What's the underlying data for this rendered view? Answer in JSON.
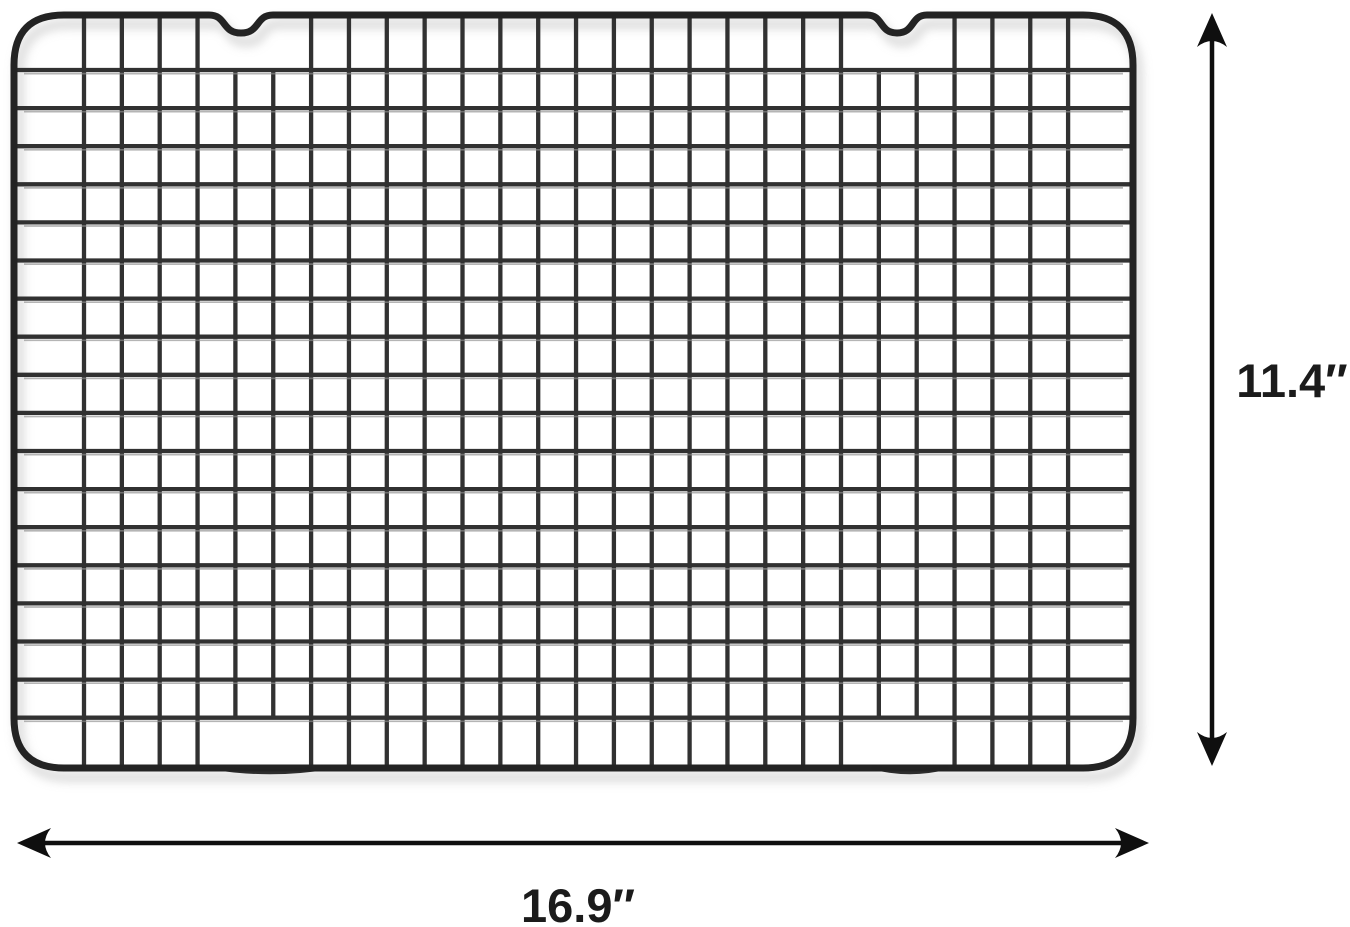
{
  "figure": {
    "description": "Dimension diagram of a dark gray wire grid cooling rack",
    "background_color": "#ffffff"
  },
  "dimensions": {
    "height_label": "11.4″",
    "width_label": "16.9″"
  },
  "rack": {
    "wire_color": "#313131",
    "frame_color": "#232323",
    "highlight_color": "#8f8f8f",
    "shadow_color": "#c6c6c6",
    "frame": {
      "left": 14,
      "top": 15,
      "right": 1133,
      "bottom": 768,
      "corner_radius": 50,
      "stroke_width": 7
    },
    "grid": {
      "v_start": 84,
      "v_count": 27,
      "v_pitch": 37.85,
      "h_start": 70,
      "h_count": 18,
      "h_pitch": 38.1,
      "wire_width": 4.3
    },
    "top_notches": [
      {
        "center": 241,
        "half_width": 32,
        "depth": 18
      },
      {
        "center": 897,
        "half_width": 30,
        "depth": 18
      }
    ],
    "bottom_feet": [
      {
        "x1": 210,
        "x2": 330
      },
      {
        "x1": 872,
        "x2": 948
      }
    ],
    "skip_top_row_wires": [
      4,
      5,
      21,
      22
    ],
    "skip_bottom_row_wires": [
      4,
      5,
      21,
      22
    ]
  },
  "annotations": {
    "color": "#0f0f0f",
    "line_width": 4.5,
    "vertical_arrow": {
      "x": 1212,
      "y1": 13,
      "y2": 766
    },
    "horizontal_arrow": {
      "y": 843,
      "x1": 17,
      "x2": 1149
    },
    "height_text": {
      "x": 1292,
      "y": 397,
      "font_size": 47
    },
    "width_text": {
      "x": 578,
      "y": 922,
      "font_size": 47
    }
  }
}
